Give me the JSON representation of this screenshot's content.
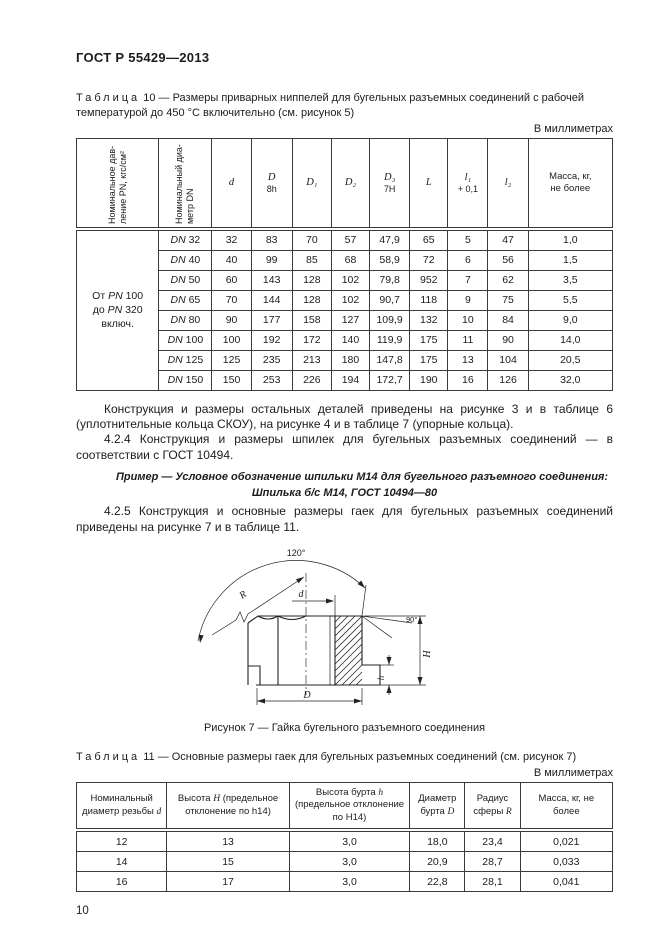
{
  "header": {
    "doc_code": "ГОСТ Р 55429—2013"
  },
  "table10": {
    "caption_word": "Таблица",
    "caption_num": "10",
    "caption_text": "— Размеры приварных ниппелей для бугельных разъемных соединений с рабочей температурой до 450 °С включительно (см. рисунок 5)",
    "units": "В миллиметрах",
    "rot_headers": [
      {
        "l1": "Номинальное дав-",
        "l2": "ление PN, кгс/см²"
      },
      {
        "l1": "Номинальный диа-",
        "l2": "метр DN"
      }
    ],
    "cols": [
      {
        "top": "d",
        "bottom": ""
      },
      {
        "top": "D",
        "bottom": "8h"
      },
      {
        "top": "D₁",
        "bottom": ""
      },
      {
        "top": "D₂",
        "bottom": ""
      },
      {
        "top": "D₃",
        "bottom": "7H"
      },
      {
        "top": "L",
        "bottom": ""
      },
      {
        "top": "l₁",
        "bottom": "+ 0,1"
      },
      {
        "top": "l₂",
        "bottom": ""
      },
      {
        "top": "Масса, кг,",
        "bottom": "не более"
      }
    ],
    "group": {
      "line1": [
        [
          "От ",
          false
        ],
        [
          "PN",
          true
        ],
        [
          " 100",
          false
        ]
      ],
      "line2": [
        [
          "до ",
          false
        ],
        [
          "PN",
          true
        ],
        [
          " 320 включ.",
          false
        ]
      ]
    },
    "rows": [
      {
        "dn_prefix": "DN",
        "dn_num": "32",
        "values": [
          "32",
          "83",
          "70",
          "57",
          "47,9",
          "65",
          "5",
          "47",
          "1,0"
        ]
      },
      {
        "dn_prefix": "DN",
        "dn_num": "40",
        "values": [
          "40",
          "99",
          "85",
          "68",
          "58,9",
          "72",
          "6",
          "56",
          "1,5"
        ]
      },
      {
        "dn_prefix": "DN",
        "dn_num": "50",
        "values": [
          "60",
          "143",
          "128",
          "102",
          "79,8",
          "952",
          "7",
          "62",
          "3,5"
        ]
      },
      {
        "dn_prefix": "DN",
        "dn_num": "65",
        "values": [
          "70",
          "144",
          "128",
          "102",
          "90,7",
          "118",
          "9",
          "75",
          "5,5"
        ]
      },
      {
        "dn_prefix": "DN",
        "dn_num": "80",
        "values": [
          "90",
          "177",
          "158",
          "127",
          "109,9",
          "132",
          "10",
          "84",
          "9,0"
        ]
      },
      {
        "dn_prefix": "DN",
        "dn_num": "100",
        "values": [
          "100",
          "192",
          "172",
          "140",
          "119,9",
          "175",
          "11",
          "90",
          "14,0"
        ]
      },
      {
        "dn_prefix": "DN",
        "dn_num": "125",
        "values": [
          "125",
          "235",
          "213",
          "180",
          "147,8",
          "175",
          "13",
          "104",
          "20,5"
        ]
      },
      {
        "dn_prefix": "DN",
        "dn_num": "150",
        "values": [
          "150",
          "253",
          "226",
          "194",
          "172,7",
          "190",
          "16",
          "126",
          "32,0"
        ]
      }
    ]
  },
  "paragraphs": {
    "p1": "Конструкция и размеры остальных деталей приведены на рисунке 3 и в таблице 6 (уплотнительные кольца СКОУ), на рисунке 4 и в таблице 7 (упорные кольца).",
    "p2": "4.2.4 Конструкция и размеры шпилек для бугельных разъемных соединений — в соответствии с ГОСТ 10494.",
    "example1": "Пример — Условное обозначение шпильки М14 для бугельного разъемного соединения:",
    "example2": "Шпилька б/с М14, ГОСТ 10494—80",
    "p3": "4.2.5 Конструкция и основные размеры гаек для бугельных разъемных соединений приведены на рисунке 7 и в таблице 11."
  },
  "figure": {
    "caption": "Рисунок 7 — Гайка бугельного разъемного соединения",
    "labels": {
      "angle_top": "120°",
      "radius": "R",
      "bore": "d",
      "angle_right": "90°",
      "height": "H",
      "collar": "h",
      "diameter": "D"
    }
  },
  "table11": {
    "caption_word": "Таблица",
    "caption_num": "11",
    "caption_text": "— Основные размеры гаек для бугельных разъемных соединений (см. рисунок 7)",
    "units": "В миллиметрах",
    "headers": [
      {
        "pre": "Номинальный диаметр резьбы ",
        "var": "d",
        "post": ""
      },
      {
        "pre": "Высота ",
        "var": "H",
        "post": " (предельное отклонение по h14)"
      },
      {
        "pre": "Высота бурта ",
        "var": "h",
        "post": " (предельное отклонение по Н14)"
      },
      {
        "pre": "Диаметр бурта ",
        "var": "D",
        "post": ""
      },
      {
        "pre": "Радиус сферы ",
        "var": "R",
        "post": ""
      },
      {
        "pre": "Масса, кг, не более",
        "var": "",
        "post": ""
      }
    ],
    "rows": [
      [
        "12",
        "13",
        "3,0",
        "18,0",
        "23,4",
        "0,021"
      ],
      [
        "14",
        "15",
        "3,0",
        "20,9",
        "28,7",
        "0,033"
      ],
      [
        "16",
        "17",
        "3,0",
        "22,8",
        "28,1",
        "0,041"
      ]
    ]
  },
  "footer": {
    "page_number": "10"
  }
}
